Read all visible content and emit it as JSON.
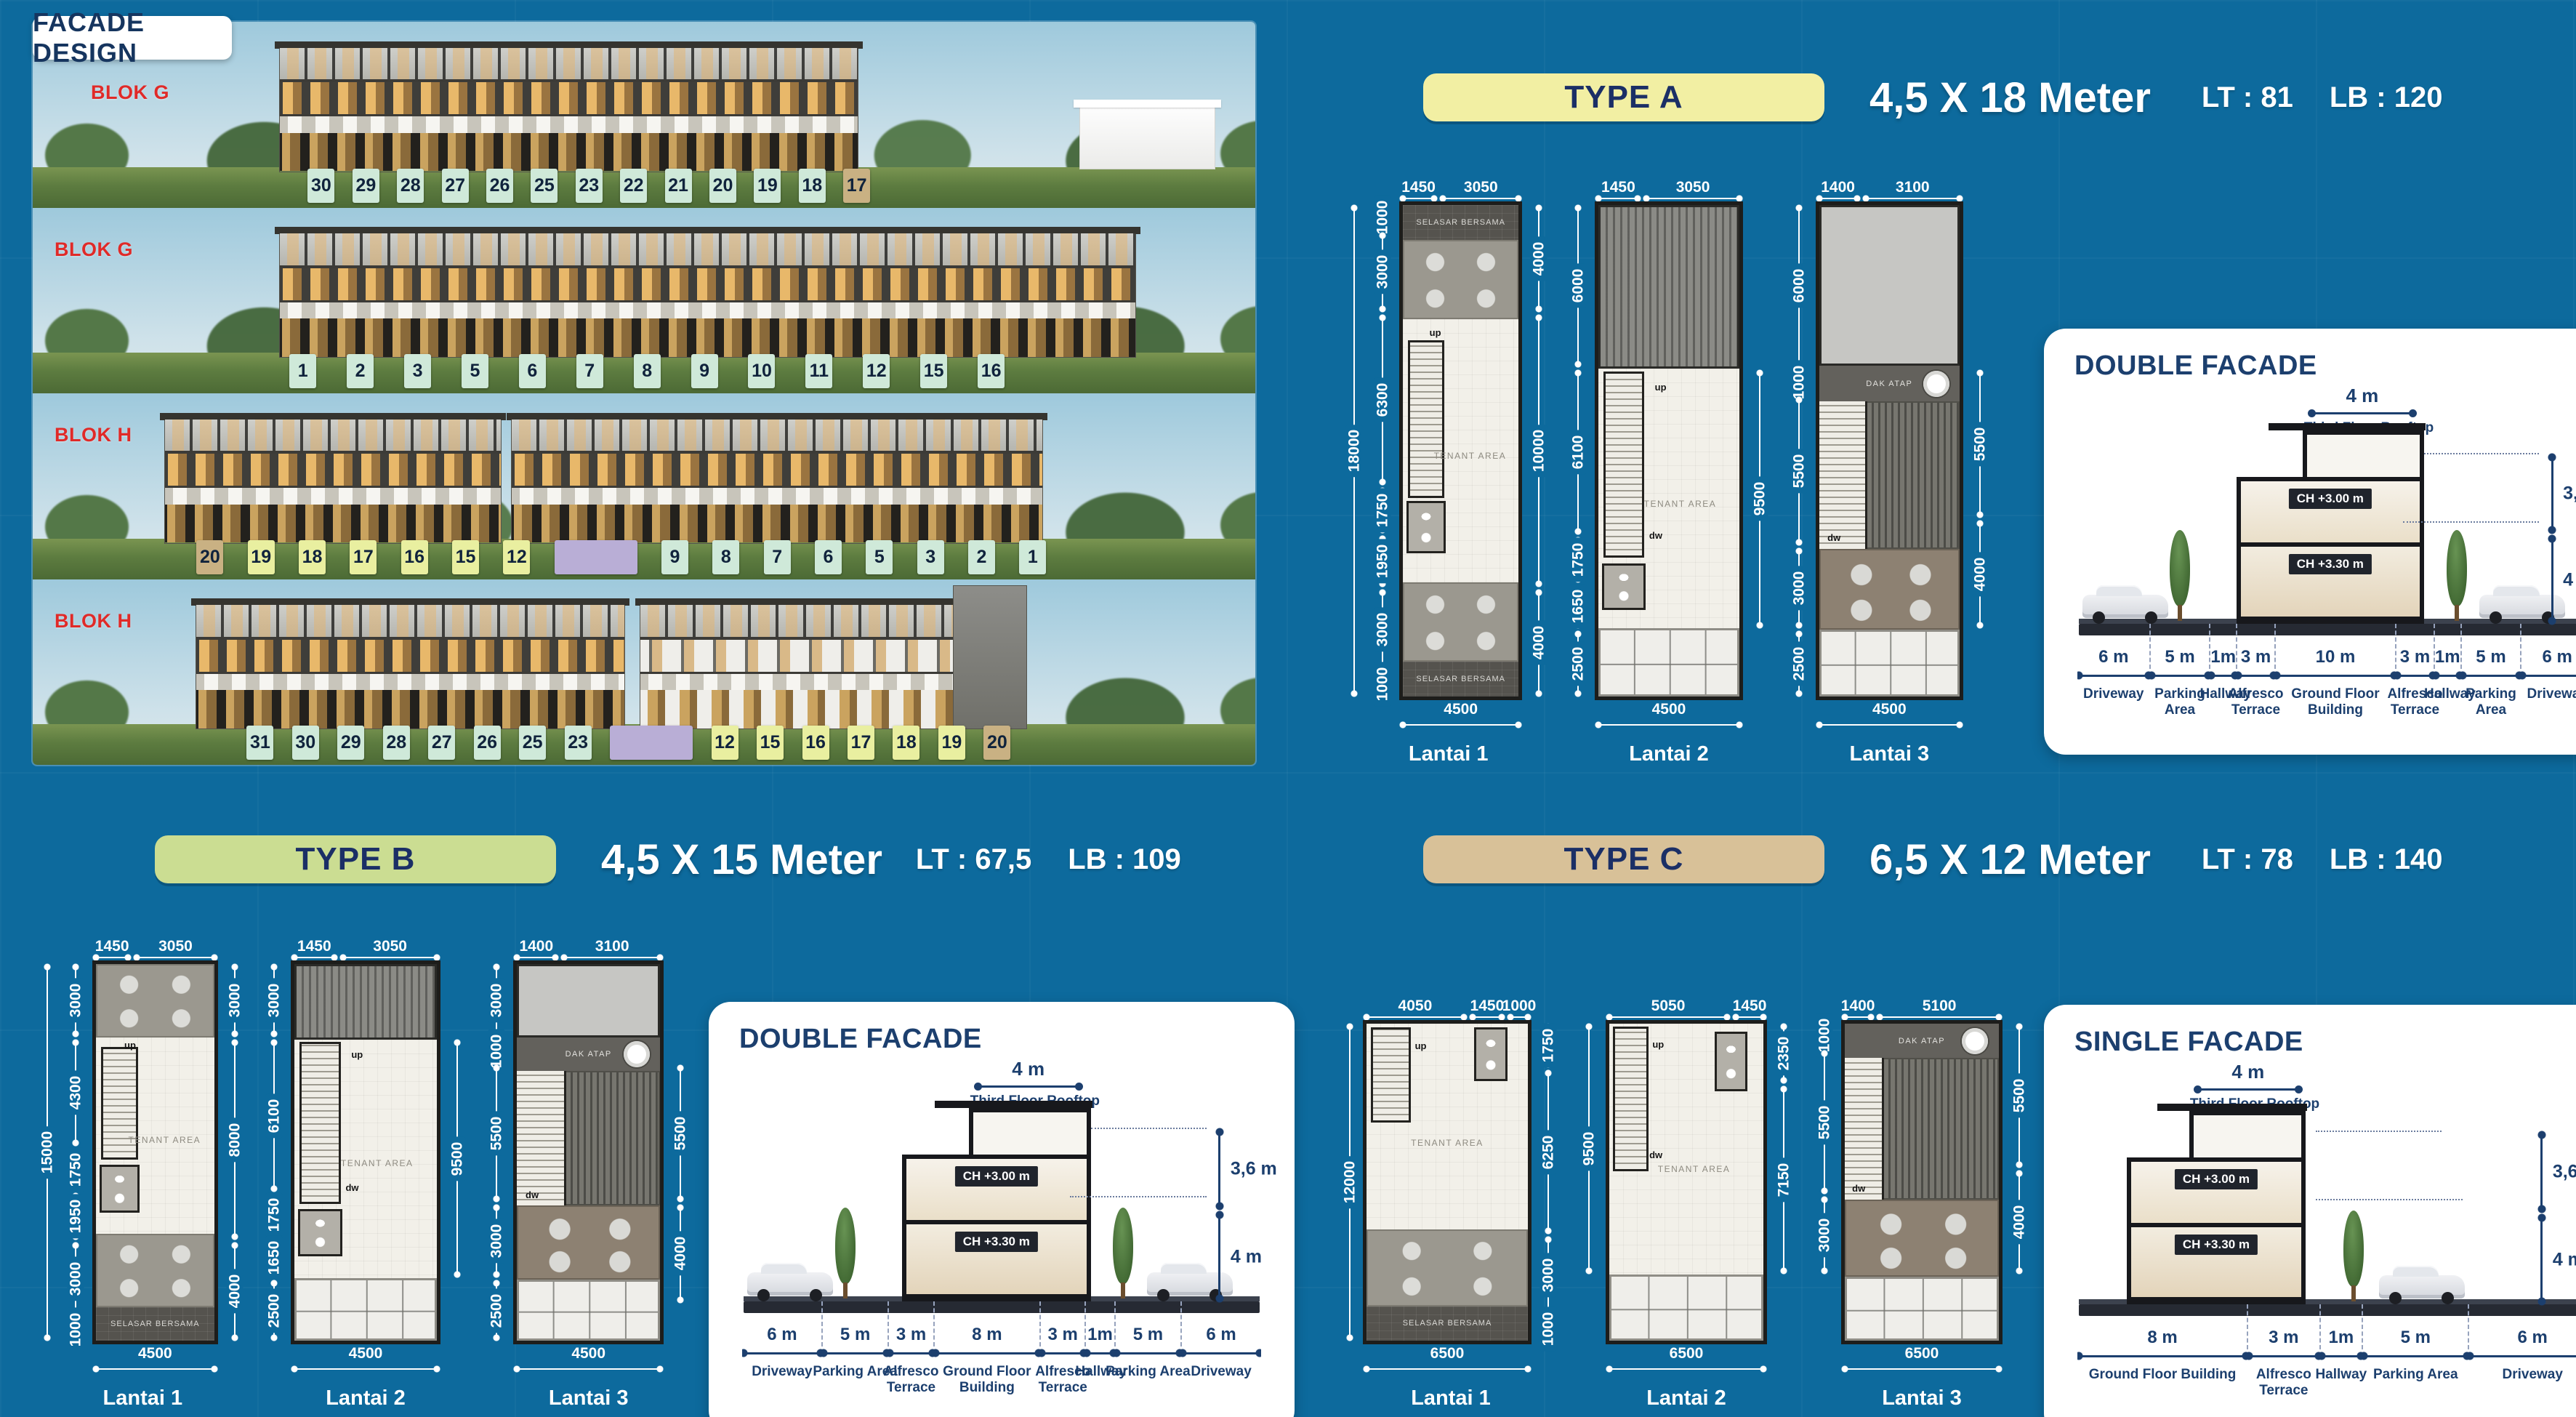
{
  "page": {
    "title": "FACADE DESIGN"
  },
  "labels": {
    "tenant": "TENANT AREA",
    "selasar": "SELASAR BERSAMA",
    "dak": "DAK ATAP",
    "up": "up",
    "dw": "dw",
    "lantai1": "Lantai 1",
    "lantai2": "Lantai 2",
    "lantai3": "Lantai 3"
  },
  "colors": {
    "background": "#0d6a9d",
    "navy": "#1c3f6e",
    "red": "#e02a28",
    "pill_a": "#f2efa3",
    "pill_b": "#cbdd92",
    "pill_c": "#d8c198",
    "badge_mint": "#cfe9d9",
    "badge_yellow": "#e9efa0",
    "badge_tan": "#c9b183",
    "badge_purple": "#b9aed6"
  },
  "facade": {
    "rows": [
      {
        "blok": "BLOK G",
        "badges": [
          {
            "n": "30",
            "c": "mint"
          },
          {
            "n": "29",
            "c": "mint"
          },
          {
            "n": "28",
            "c": "mint"
          },
          {
            "n": "27",
            "c": "mint"
          },
          {
            "n": "26",
            "c": "mint"
          },
          {
            "n": "25",
            "c": "mint"
          },
          {
            "n": "23",
            "c": "mint"
          },
          {
            "n": "22",
            "c": "mint"
          },
          {
            "n": "21",
            "c": "mint"
          },
          {
            "n": "20",
            "c": "mint"
          },
          {
            "n": "19",
            "c": "mint"
          },
          {
            "n": "18",
            "c": "mint"
          },
          {
            "n": "17",
            "c": "tan"
          }
        ]
      },
      {
        "blok": "BLOK G",
        "badges": [
          {
            "n": "1",
            "c": "mint"
          },
          {
            "n": "2",
            "c": "mint"
          },
          {
            "n": "3",
            "c": "mint"
          },
          {
            "n": "5",
            "c": "mint"
          },
          {
            "n": "6",
            "c": "mint"
          },
          {
            "n": "7",
            "c": "mint"
          },
          {
            "n": "8",
            "c": "mint"
          },
          {
            "n": "9",
            "c": "mint"
          },
          {
            "n": "10",
            "c": "mint"
          },
          {
            "n": "11",
            "c": "mint"
          },
          {
            "n": "12",
            "c": "mint"
          },
          {
            "n": "15",
            "c": "mint"
          },
          {
            "n": "16",
            "c": "mint"
          }
        ]
      },
      {
        "blok": "BLOK H",
        "badges": [
          {
            "n": "20",
            "c": "tan"
          },
          {
            "n": "19",
            "c": "yellow"
          },
          {
            "n": "18",
            "c": "yellow"
          },
          {
            "n": "17",
            "c": "yellow"
          },
          {
            "n": "16",
            "c": "yellow"
          },
          {
            "n": "15",
            "c": "yellow"
          },
          {
            "n": "12",
            "c": "yellow"
          },
          {
            "n": "",
            "c": "purple"
          },
          {
            "n": "9",
            "c": "mint"
          },
          {
            "n": "8",
            "c": "mint"
          },
          {
            "n": "7",
            "c": "mint"
          },
          {
            "n": "6",
            "c": "mint"
          },
          {
            "n": "5",
            "c": "mint"
          },
          {
            "n": "3",
            "c": "mint"
          },
          {
            "n": "2",
            "c": "mint"
          },
          {
            "n": "1",
            "c": "mint"
          }
        ]
      },
      {
        "blok": "BLOK H",
        "badges": [
          {
            "n": "31",
            "c": "mint"
          },
          {
            "n": "30",
            "c": "mint"
          },
          {
            "n": "29",
            "c": "mint"
          },
          {
            "n": "28",
            "c": "mint"
          },
          {
            "n": "27",
            "c": "mint"
          },
          {
            "n": "26",
            "c": "mint"
          },
          {
            "n": "25",
            "c": "mint"
          },
          {
            "n": "23",
            "c": "mint"
          },
          {
            "n": "",
            "c": "purple"
          },
          {
            "n": "12",
            "c": "yellow"
          },
          {
            "n": "15",
            "c": "yellow"
          },
          {
            "n": "16",
            "c": "yellow"
          },
          {
            "n": "17",
            "c": "yellow"
          },
          {
            "n": "18",
            "c": "yellow"
          },
          {
            "n": "19",
            "c": "yellow"
          },
          {
            "n": "20",
            "c": "tan"
          }
        ]
      }
    ]
  },
  "types": {
    "a": {
      "label": "TYPE A",
      "size": "4,5 X 18 Meter",
      "lt": "LT : 81",
      "lb": "LB : 120",
      "plans": [
        {
          "name": "Lantai 1",
          "overall": [
            "18000"
          ],
          "top": [
            "1450",
            "3050"
          ],
          "left": [
            "1000",
            "3000",
            "6300",
            "1750",
            "1950",
            "3000",
            "1000"
          ],
          "right": [
            "4000",
            "10000",
            "4000"
          ],
          "bottom": "4500"
        },
        {
          "name": "Lantai 2",
          "top": [
            "1450",
            "3050"
          ],
          "left": [
            "6000",
            "6100",
            "1750",
            "1650",
            "2500"
          ],
          "right": [
            "~6000",
            "9500",
            "~2500"
          ],
          "bottom": "4500"
        },
        {
          "name": "Lantai 3",
          "top": [
            "1400",
            "3100"
          ],
          "left": [
            "6000",
            "1000",
            "5500",
            "3000",
            "2500"
          ],
          "right": [
            "~6000",
            "5500",
            "4000",
            "~2500"
          ],
          "bottom": "4500"
        }
      ],
      "card": {
        "title": "DOUBLE FACADE",
        "roof_len": "4 m",
        "roof_label": "Third Floor Rooftop",
        "ch_upper": "CH +3.00 m",
        "ch_lower": "CH +3.30 m",
        "dim_upper": "3,6 m",
        "dim_lower": "4 m",
        "scale": [
          {
            "len": "6 m",
            "name": "Driveway",
            "v": 6
          },
          {
            "len": "5 m",
            "name": "Parking Area",
            "v": 5
          },
          {
            "len": "1m",
            "name": "Hallway",
            "v": 2.2
          },
          {
            "len": "3 m",
            "name": "Alfresco Terrace",
            "v": 3.2
          },
          {
            "len": "10 m",
            "name": "Ground Floor Building",
            "v": 10
          },
          {
            "len": "3 m",
            "name": "Alfresco Terrace",
            "v": 3.2
          },
          {
            "len": "1m",
            "name": "Hallway",
            "v": 2.2
          },
          {
            "len": "5 m",
            "name": "Parking Area",
            "v": 5
          },
          {
            "len": "6 m",
            "name": "Driveway",
            "v": 6
          }
        ]
      }
    },
    "b": {
      "label": "TYPE B",
      "size": "4,5 X 15 Meter",
      "lt": "LT : 67,5",
      "lb": "LB : 109",
      "plans": [
        {
          "name": "Lantai 1",
          "overall": [
            "15000"
          ],
          "top": [
            "1450",
            "3050"
          ],
          "left": [
            "3000",
            "4300",
            "1750",
            "1950",
            "3000",
            "1000"
          ],
          "right": [
            "3000",
            "8000",
            "4000"
          ],
          "bottom": "4500"
        },
        {
          "name": "Lantai 2",
          "top": [
            "1450",
            "3050"
          ],
          "left": [
            "3000",
            "6100",
            "1750",
            "1650",
            "2500"
          ],
          "right": [
            "~3000",
            "9500",
            "~2500"
          ],
          "bottom": "4500"
        },
        {
          "name": "Lantai 3",
          "top": [
            "1400",
            "3100"
          ],
          "left": [
            "3000",
            "1000",
            "5500",
            "3000",
            "2500"
          ],
          "right": [
            "~4000",
            "5500",
            "4000",
            "~1500"
          ],
          "bottom": "4500"
        }
      ],
      "card": {
        "title": "DOUBLE FACADE",
        "roof_len": "4 m",
        "roof_label": "Third Floor Rooftop",
        "ch_upper": "CH +3.00 m",
        "ch_lower": "CH +3.30 m",
        "dim_upper": "3,6 m",
        "dim_lower": "4 m",
        "scale": [
          {
            "len": "6 m",
            "name": "Driveway",
            "v": 6
          },
          {
            "len": "5 m",
            "name": "Parking Area",
            "v": 5
          },
          {
            "len": "3 m",
            "name": "Alfresco Terrace",
            "v": 3.4
          },
          {
            "len": "8 m",
            "name": "Ground Floor Building",
            "v": 8
          },
          {
            "len": "3 m",
            "name": "Alfresco Terrace",
            "v": 3.4
          },
          {
            "len": "1m",
            "name": "Hallway",
            "v": 2.2
          },
          {
            "len": "5 m",
            "name": "Parking Area",
            "v": 5
          },
          {
            "len": "6 m",
            "name": "Driveway",
            "v": 6
          }
        ]
      }
    },
    "c": {
      "label": "TYPE C",
      "size": "6,5 X 12 Meter",
      "lt": "LT : 78",
      "lb": "LB : 140",
      "plans": [
        {
          "name": "Lantai 1",
          "overall": [
            "12000"
          ],
          "top": [
            "4050",
            "1450",
            "1000"
          ],
          "left": [],
          "right": [
            "1750",
            "6250",
            "3000",
            "1000"
          ],
          "bottom": "6500"
        },
        {
          "name": "Lantai 2",
          "top": [
            "5050",
            "1450"
          ],
          "left": [
            "9500",
            "~2500"
          ],
          "right": [
            "2350",
            "7150",
            "~2500"
          ],
          "bottom": "6500"
        },
        {
          "name": "Lantai 3",
          "top": [
            "1400",
            "5100"
          ],
          "left": [
            "1000",
            "5500",
            "3000",
            "~2500"
          ],
          "right": [
            "5500",
            "4000",
            "~2500"
          ],
          "bottom": "6500"
        }
      ],
      "card": {
        "title": "SINGLE FACADE",
        "roof_len": "4 m",
        "roof_label": "Third Floor Rooftop",
        "ch_upper": "CH +3.00 m",
        "ch_lower": "CH +3.30 m",
        "dim_upper": "3,6 m",
        "dim_lower": "4 m",
        "scale": [
          {
            "len": "8 m",
            "name": "Ground Floor Building",
            "v": 8
          },
          {
            "len": "3 m",
            "name": "Alfresco Terrace",
            "v": 3.4
          },
          {
            "len": "1m",
            "name": "Hallway",
            "v": 2
          },
          {
            "len": "5 m",
            "name": "Parking Area",
            "v": 5
          },
          {
            "len": "6 m",
            "name": "Driveway",
            "v": 6
          }
        ]
      }
    }
  }
}
